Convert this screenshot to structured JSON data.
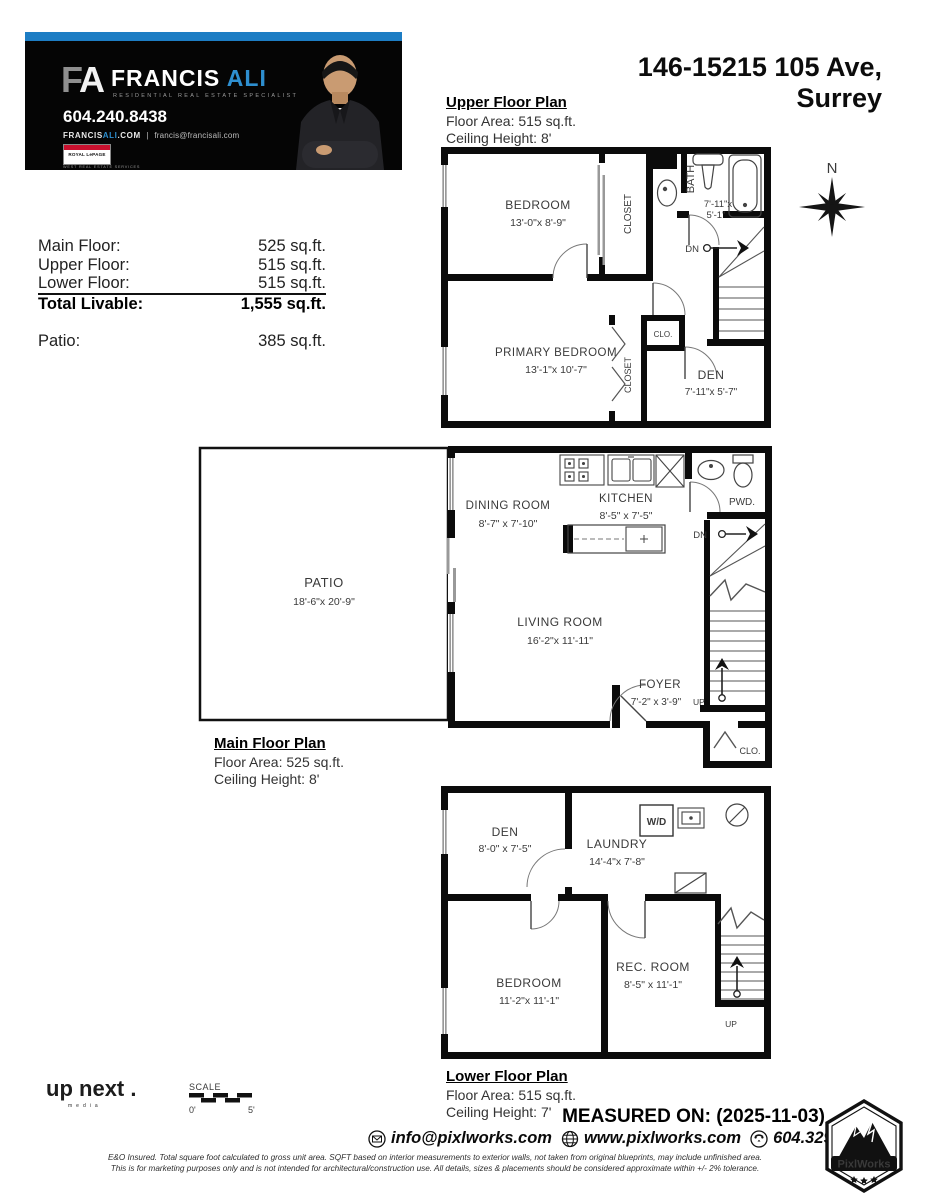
{
  "banner": {
    "logo_f": "F",
    "logo_a": "A",
    "name_first": "FRANCIS",
    "name_last": "ALI",
    "tagline": "RESIDENTIAL REAL ESTATE SPECIALIST",
    "phone": "604.240.8438",
    "web_white": "FRANCIS",
    "web_blue": "ALI",
    "web_dot": ".COM",
    "web_sep": "|",
    "email": "francis@francisali.com",
    "brokerage": "ROYAL LePAGE",
    "brokerage_sub": "WEST REAL ESTATE SERVICES",
    "accent_color": "#1d7dc4"
  },
  "address": {
    "line1": "146-15215 105 Ave,",
    "line2": "Surrey"
  },
  "summary": {
    "rows": [
      {
        "label": "Main Floor:",
        "value": "525 sq.ft."
      },
      {
        "label": "Upper Floor:",
        "value": "515 sq.ft."
      },
      {
        "label": "Lower Floor:",
        "value": "515 sq.ft."
      }
    ],
    "total_label": "Total Livable:",
    "total_value": "1,555 sq.ft.",
    "patio_label": "Patio:",
    "patio_value": "385 sq.ft."
  },
  "floors": {
    "upper": {
      "title": "Upper Floor Plan",
      "area": "Floor Area: 515 sq.ft.",
      "ceiling": "Ceiling Height: 8'"
    },
    "main": {
      "title": "Main Floor Plan",
      "area": "Floor Area: 525 sq.ft.",
      "ceiling": "Ceiling Height: 8'"
    },
    "lower": {
      "title": "Lower Floor Plan",
      "area": "Floor Area: 515 sq.ft.",
      "ceiling": "Ceiling Height: 7'"
    }
  },
  "rooms": {
    "upper": {
      "bedroom": {
        "name": "BEDROOM",
        "dims": "13'-0\"x 8'-9\""
      },
      "primary": {
        "name": "PRIMARY BEDROOM",
        "dims": "13'-1\"x 10'-7\""
      },
      "bath": {
        "name": "BATH",
        "dims1": "7'-11\"x",
        "dims2": "5'-1\""
      },
      "den": {
        "name": "DEN",
        "dims": "7'-11\"x 5'-7\""
      },
      "closet1": "CLOSET",
      "closet2": "CLOSET",
      "clo": "CLO.",
      "dn": "DN"
    },
    "main": {
      "patio": {
        "name": "PATIO",
        "dims": "18'-6\"x 20'-9\""
      },
      "dining": {
        "name": "DINING ROOM",
        "dims": "8'-7\" x 7'-10\""
      },
      "kitchen": {
        "name": "KITCHEN",
        "dims": "8'-5\" x 7'-5\""
      },
      "living": {
        "name": "LIVING ROOM",
        "dims": "16'-2\"x 11'-11\""
      },
      "foyer": {
        "name": "FOYER",
        "dims": "7'-2\" x 3'-9\""
      },
      "pwd": "PWD.",
      "clo": "CLO.",
      "dn": "DN",
      "up": "UP"
    },
    "lower": {
      "den": {
        "name": "DEN",
        "dims": "8'-0\" x 7'-5\""
      },
      "laundry": {
        "name": "LAUNDRY",
        "dims": "14'-4\"x 7'-8\""
      },
      "bedroom": {
        "name": "BEDROOM",
        "dims": "11'-2\"x 11'-1\""
      },
      "rec": {
        "name": "REC. ROOM",
        "dims": "8'-5\" x 11'-1\""
      },
      "wd": "W/D",
      "up": "UP"
    }
  },
  "compass": {
    "label": "N"
  },
  "footer": {
    "upnext_word1": "up",
    "upnext_word2": "next",
    "upnext_dot": " .",
    "upnext_sub": "media",
    "scale": {
      "label": "SCALE",
      "start": "0'",
      "end": "5'"
    },
    "measured_on": "MEASURED ON: (2025-11-03)",
    "contact_email": "info@pixlworks.com",
    "contact_web": "www.pixlworks.com",
    "contact_phone": "604.329.5788",
    "pixlworks_label": "PixlWorks",
    "disclaimer1": "E&O Insured.  Total square foot calculated to gross unit area. SQFT based on interior measurements to exterior walls, not taken from original blueprints, may include unfinished area.",
    "disclaimer2": "This is for marketing purposes only and is not intended for architectural/construction use.  All details, sizes & placements should be considered approximate within +/- 2%  tolerance."
  }
}
